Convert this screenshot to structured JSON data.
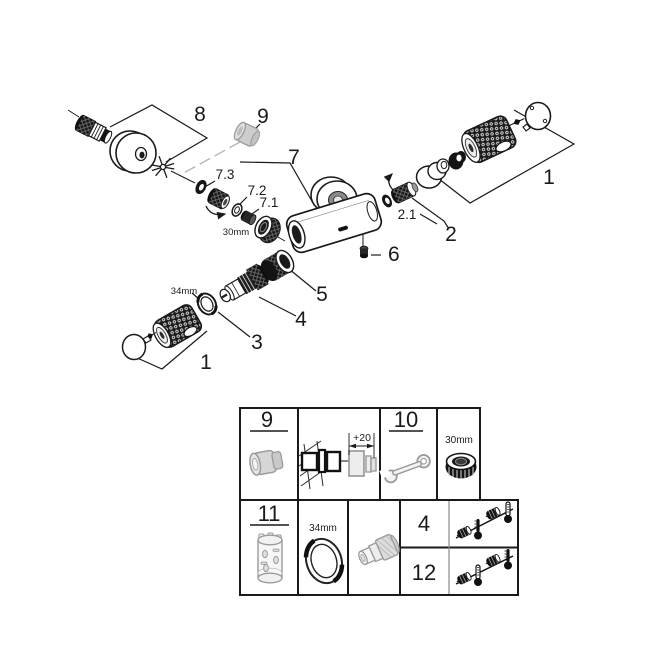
{
  "diagram": {
    "labels": {
      "part8": "8",
      "part9": "9",
      "part7": "7",
      "part7_3": "7.3",
      "part7_2": "7.2",
      "part7_1": "7.1",
      "nut_size": "30mm",
      "part6": "6",
      "part1_right": "1",
      "part2_1": "2.1",
      "part2": "2",
      "part5": "5",
      "part4": "4",
      "part3": "3",
      "ring_size": "34mm",
      "part1_bottom": "1"
    }
  },
  "table": {
    "spare_cap": {
      "number": "9"
    },
    "installation": {
      "dimension": "+20"
    },
    "tool_wrench": {
      "number": "10"
    },
    "tool_nut": {
      "size": "30mm"
    },
    "spare_sleeve": {
      "number": "11"
    },
    "tool_ring": {
      "size": "34mm"
    },
    "spare_checkvalve": {
      "number": "4"
    },
    "spare_thermo": {
      "number": "12"
    }
  },
  "icons": {
    "cap": "cap-plug-icon",
    "wall": "wall-mount-extension-icon",
    "wrench": "open-end-wrench-icon",
    "nut": "union-nut-icon",
    "sleeve": "extension-sleeve-icon",
    "ring": "ring-nut-icon",
    "connector": "adapter-connector-icon",
    "valve": "check-valve-icon",
    "thermometer": "thermometer-icon"
  },
  "colors": {
    "line": "#1a1a1a",
    "ghost": "#9b9b9b",
    "ghost_fill": "#dcdcdc",
    "background": "#ffffff"
  }
}
